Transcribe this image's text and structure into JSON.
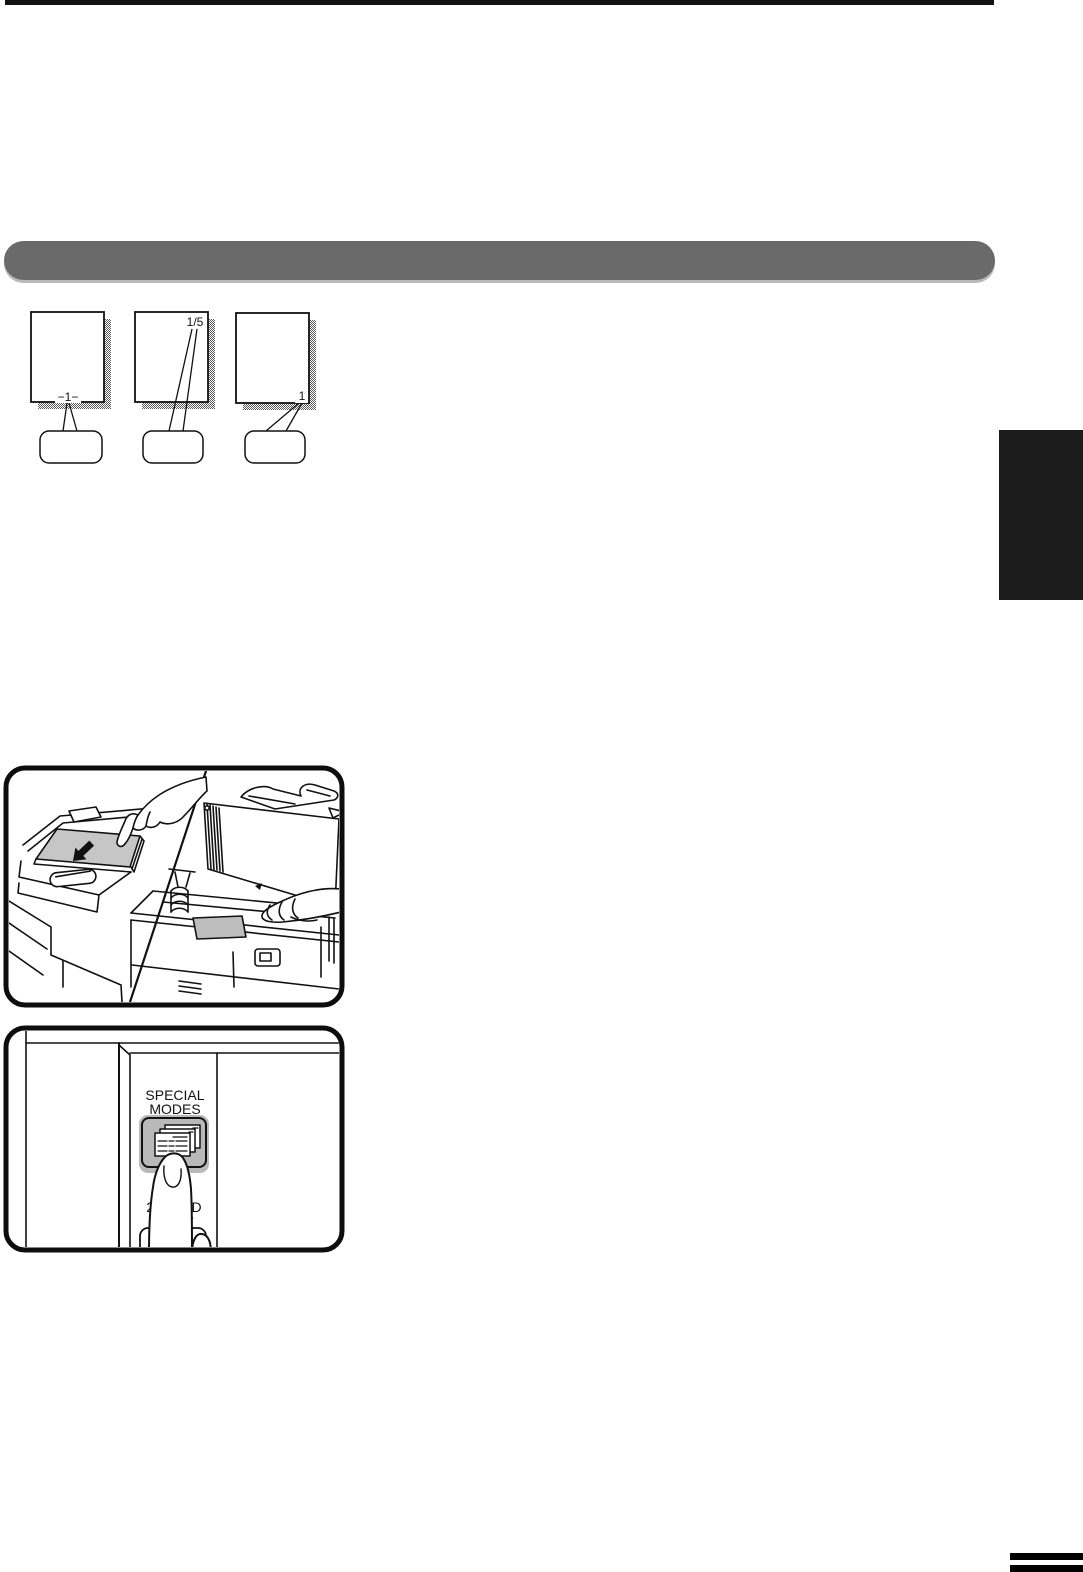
{
  "page": {
    "background": "#ffffff"
  },
  "decor": {
    "top_rule_color": "#121212",
    "heading_bar_color": "#6a6a6a",
    "chapter_tab_color": "#1b1b1b",
    "footer_mark_color": "#000000",
    "line_color": "#111111"
  },
  "numbering_examples": [
    {
      "name": "page-number-bottom-center",
      "label": "−1−"
    },
    {
      "name": "page-number-top-right",
      "label": "1/5"
    },
    {
      "name": "page-number-bottom-right",
      "label": "1"
    }
  ],
  "copier_illustration": {
    "paper_stack_color": "#c6c6c6",
    "platen_document_color": "#bdbdbd"
  },
  "panel_illustration": {
    "special_modes_key": {
      "line1": "SPECIAL",
      "line2": "MODES",
      "color": "#b9b9b9"
    },
    "two_sided_copy_key": {
      "line1": "2-SIDED",
      "line2": "COPY"
    }
  }
}
